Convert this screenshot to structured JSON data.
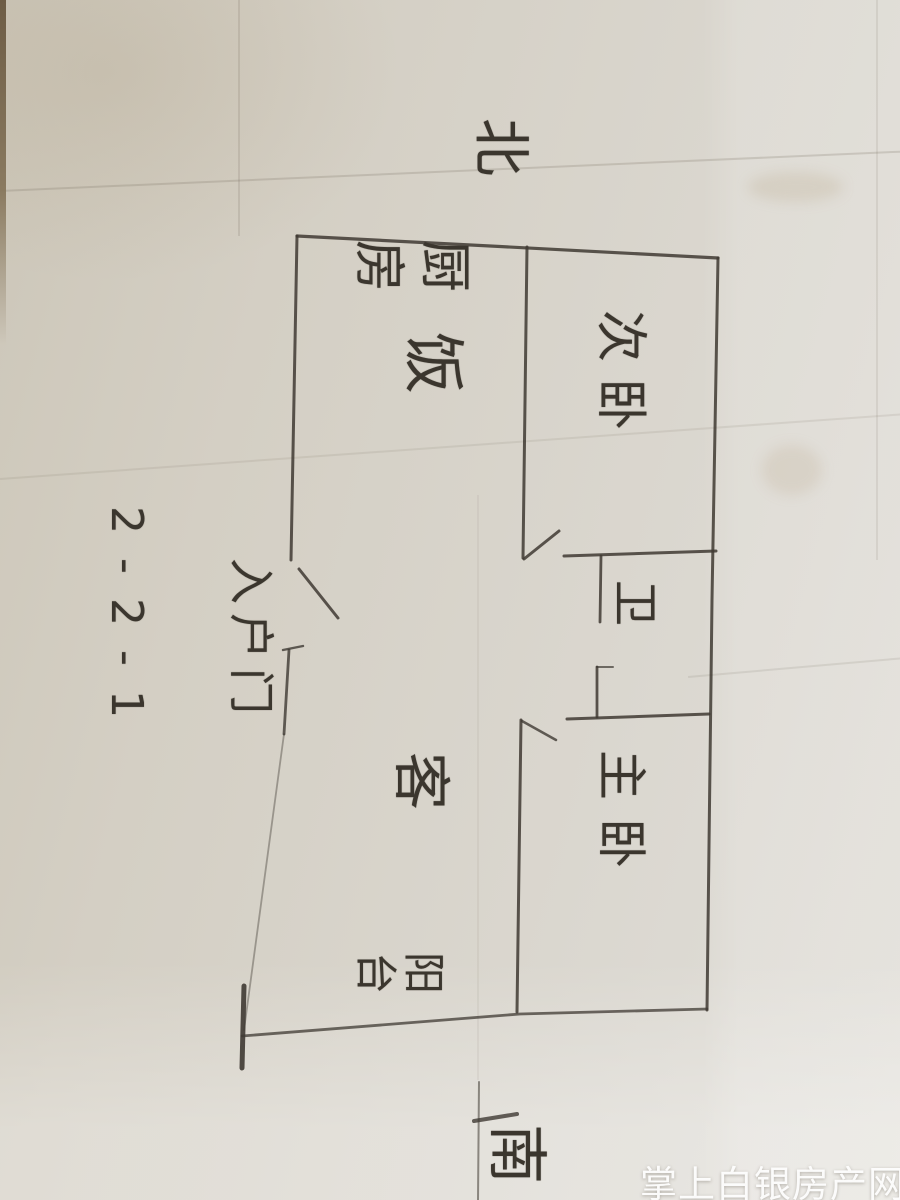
{
  "compass": {
    "north": "北",
    "south": "南"
  },
  "plan_code": "2-2-1",
  "rooms": {
    "kitchen": "厨房",
    "dining": "饭",
    "secondary_bedroom": "次卧",
    "bathroom": "卫",
    "entrance": "入户门",
    "living": "客",
    "master_bedroom": "主卧",
    "balcony": "阳台"
  },
  "watermark": {
    "text": "掌上白银房产网"
  },
  "colors": {
    "paper": "#d5d0c5",
    "pencil": "#3f3a33",
    "watermark_text": "#ffffff"
  }
}
